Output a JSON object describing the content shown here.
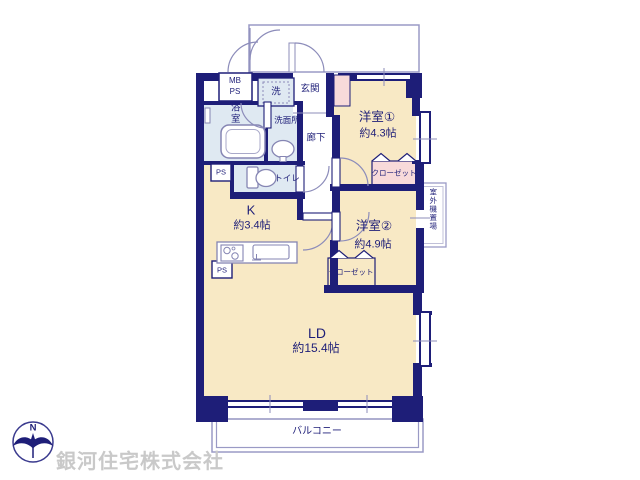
{
  "floorplan": {
    "rooms": {
      "western1": {
        "label": "洋室①",
        "size": "約4.3帖"
      },
      "western2": {
        "label": "洋室②",
        "size": "約4.9帖"
      },
      "living_dining": {
        "label": "LD",
        "size": "約15.4帖"
      },
      "kitchen": {
        "label": "K",
        "size": "約3.4帖"
      },
      "bathroom": {
        "label": "浴室"
      },
      "washroom": {
        "label": "洗面所"
      },
      "toilet": {
        "label": "トイレ"
      },
      "entrance": {
        "label": "玄関"
      },
      "hallway": {
        "label": "廊下"
      },
      "laundry": {
        "label": "洗"
      },
      "closet1": {
        "label": "クローゼット"
      },
      "closet2": {
        "label": "クローゼット"
      },
      "balcony": {
        "label": "バルコニー"
      },
      "outdoor_unit": {
        "label": "室外機置場"
      }
    },
    "utility_labels": {
      "mb": "MB",
      "ps": "PS"
    },
    "compass": {
      "north": "N"
    },
    "watermark": "銀河住宅株式会社",
    "colors": {
      "wall": "#1e1e78",
      "room_fill": "#f8e9c5",
      "wet_fill": "#dfe9f2",
      "closet_fill": "#f8dada",
      "line": "#9a9ac5",
      "watermark": "#c9c9c9"
    }
  }
}
